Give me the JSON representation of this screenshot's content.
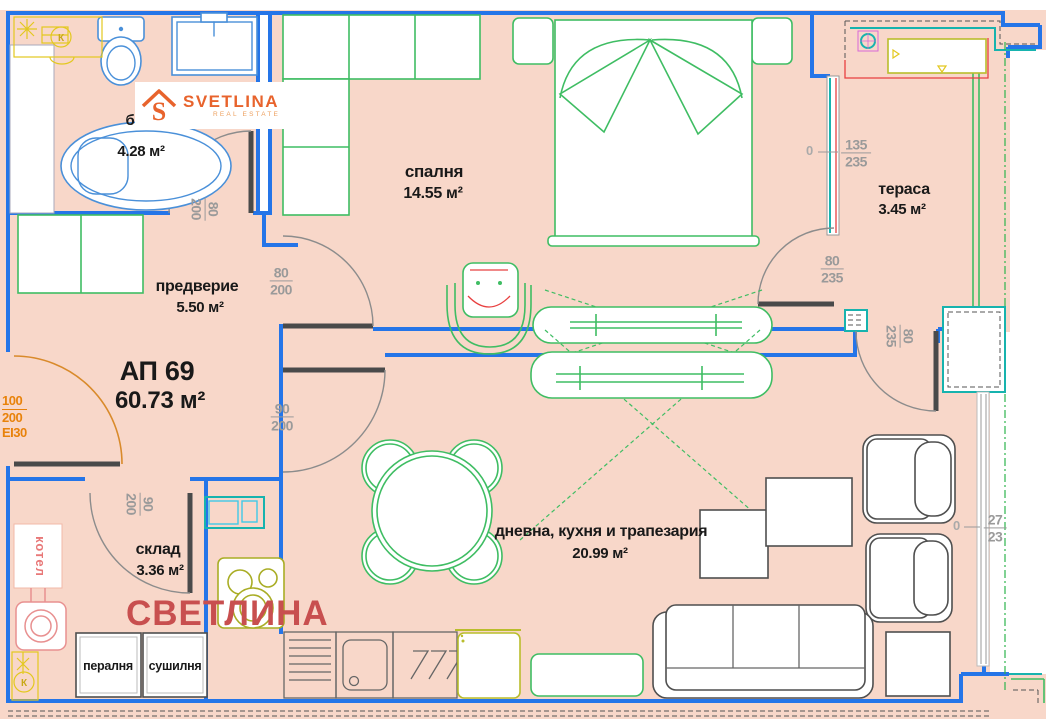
{
  "apartment": {
    "id": "АП 69",
    "total_area": "60.73 м²"
  },
  "logo": {
    "brand": "SVETLINA",
    "tagline": "REAL ESTATE",
    "monogram": "S"
  },
  "watermark": "СВЕТЛИНА",
  "rooms": {
    "bathroom": {
      "label": "б",
      "area": "4.28 м²"
    },
    "bedroom": {
      "label": "спалня",
      "area": "14.55 м²"
    },
    "terrace": {
      "label": "тераса",
      "area": "3.45 м²"
    },
    "hallway": {
      "label": "предверие",
      "area": "5.50 м²"
    },
    "storage": {
      "label": "склад",
      "area": "3.36 м²"
    },
    "living": {
      "label": "дневна, кухня и трапезария",
      "area": "20.99 м²"
    },
    "boiler_room": {
      "label": "котел"
    }
  },
  "appliances": {
    "washer": "пералня",
    "dryer": "сушилня"
  },
  "symbols": {
    "drain": "К"
  },
  "dims": {
    "bathroom_door": {
      "w": "80",
      "h": "200"
    },
    "bedroom_door": {
      "w": "80",
      "h": "200"
    },
    "living_door": {
      "w": "90",
      "h": "200"
    },
    "storage_door": {
      "w": "90",
      "h": "200"
    },
    "entrance_door": {
      "w": "100",
      "h": "200",
      "fire_rating": "EI30"
    },
    "bedroom_terrace_door": {
      "w": "80",
      "h": "235"
    },
    "living_terrace_door": {
      "w": "80",
      "h": "235"
    },
    "bedroom_window": {
      "w": "135",
      "h": "235",
      "datum": "0"
    },
    "living_window": {
      "w": "27",
      "h": "23",
      "datum": "0"
    }
  },
  "colors": {
    "floor": "#f8d7c9",
    "wall": "#2575e8",
    "furniture_green": "#3fbd63",
    "teal": "#17b3ae",
    "cyan": "#3fc9e8",
    "olive": "#a9ad25",
    "yellow": "#e3c81f",
    "orange_door": "#e8820a",
    "logo_orange": "#e8632c",
    "accent_red": "#e84040",
    "watermark_red": "#c84f4f",
    "dim_gray": "#9a9a9a",
    "furniture_gray": "#4f4f4f"
  }
}
